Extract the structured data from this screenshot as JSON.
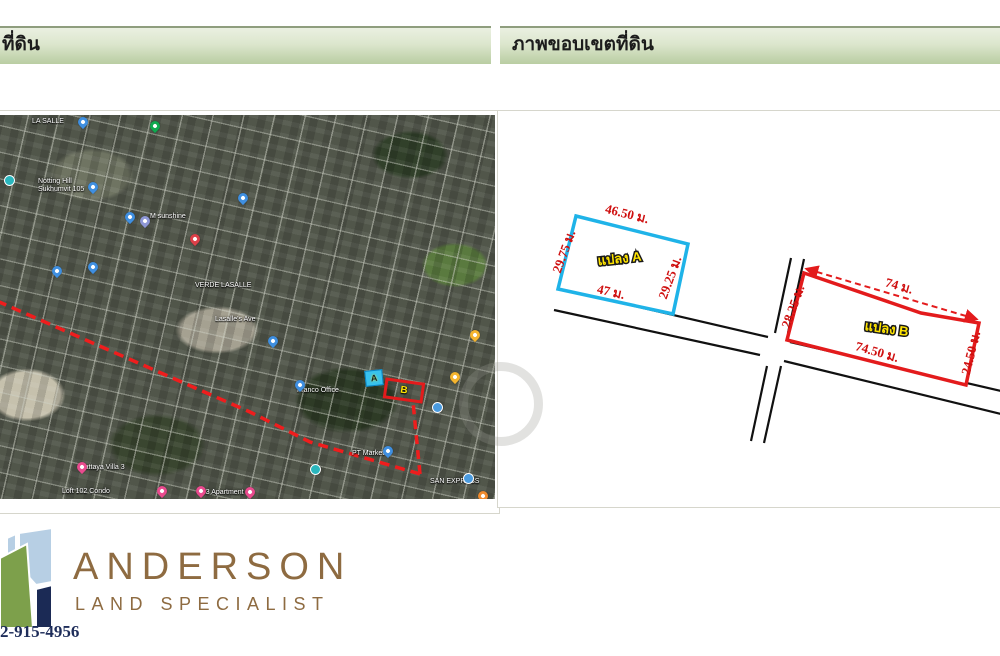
{
  "headers": {
    "left_title": "ที่ดิน",
    "right_title": "ภาพขอบเขตที่ดิน",
    "bar_top_color": "#eaf0e1",
    "bar_bottom_color": "#b9cda2"
  },
  "map": {
    "marker_a_letter": "A",
    "marker_b_letter": "B",
    "route_color": "#ef1d1d",
    "labels": [
      {
        "text": "LA SALLE",
        "x": 35,
        "y": 3
      },
      {
        "text": "Notting Hill\nSukhumvit 105",
        "x": 41,
        "y": 63
      },
      {
        "text": "M sunshine",
        "x": 153,
        "y": 98
      },
      {
        "text": "VERDE LASALLE",
        "x": 198,
        "y": 167
      },
      {
        "text": "Lasalle's Ave",
        "x": 218,
        "y": 201
      },
      {
        "text": "Franco Office",
        "x": 300,
        "y": 272
      },
      {
        "text": "PT Market",
        "x": 355,
        "y": 335
      },
      {
        "text": "Pattaya Villa 3",
        "x": 83,
        "y": 349
      },
      {
        "text": "Loft 102 Condo",
        "x": 65,
        "y": 373
      },
      {
        "text": "503 Apartment",
        "x": 201,
        "y": 374
      },
      {
        "text": "SAN EXPRESS",
        "x": 433,
        "y": 363
      }
    ],
    "pins": [
      {
        "kind": "green-transit",
        "x": 153,
        "y": 6
      },
      {
        "kind": "blue",
        "x": 81,
        "y": 2
      },
      {
        "kind": "blue",
        "x": 91,
        "y": 67
      },
      {
        "kind": "blue",
        "x": 241,
        "y": 78
      },
      {
        "kind": "teal",
        "x": 7,
        "y": 60
      },
      {
        "kind": "blue",
        "x": 128,
        "y": 97
      },
      {
        "kind": "purple",
        "x": 143,
        "y": 101
      },
      {
        "kind": "red",
        "x": 193,
        "y": 119
      },
      {
        "kind": "blue",
        "x": 55,
        "y": 151
      },
      {
        "kind": "blue",
        "x": 91,
        "y": 147
      },
      {
        "kind": "blue",
        "x": 271,
        "y": 221
      },
      {
        "kind": "blue",
        "x": 298,
        "y": 265
      },
      {
        "kind": "yellow",
        "x": 453,
        "y": 257
      },
      {
        "kind": "yellow",
        "x": 473,
        "y": 215
      },
      {
        "kind": "blue-circle",
        "x": 435,
        "y": 287
      },
      {
        "kind": "blue",
        "x": 386,
        "y": 331
      },
      {
        "kind": "pink",
        "x": 80,
        "y": 347
      },
      {
        "kind": "pink",
        "x": 160,
        "y": 371
      },
      {
        "kind": "pink",
        "x": 199,
        "y": 371
      },
      {
        "kind": "pink",
        "x": 248,
        "y": 372
      },
      {
        "kind": "teal-circle",
        "x": 313,
        "y": 349
      },
      {
        "kind": "orange",
        "x": 481,
        "y": 376
      },
      {
        "kind": "blue-circle",
        "x": 466,
        "y": 358
      }
    ]
  },
  "diagram": {
    "parcel_a": {
      "name": "แปลง A",
      "top": "46.50 ม.",
      "left": "29.75 ม.",
      "right": "29.25 ม.",
      "bottom": "47 ม.",
      "color": "#1fb3e8"
    },
    "parcel_b": {
      "name": "แปลง B",
      "top": "74 ม.",
      "left": "28.25 ม.",
      "right": "24.50 ม.",
      "bottom": "74.50 ม.",
      "color": "#e31b1c"
    }
  },
  "footer": {
    "brand": "ANDERSON",
    "tagline": "LAND SPECIALIST",
    "phone": "2-915-4956"
  }
}
